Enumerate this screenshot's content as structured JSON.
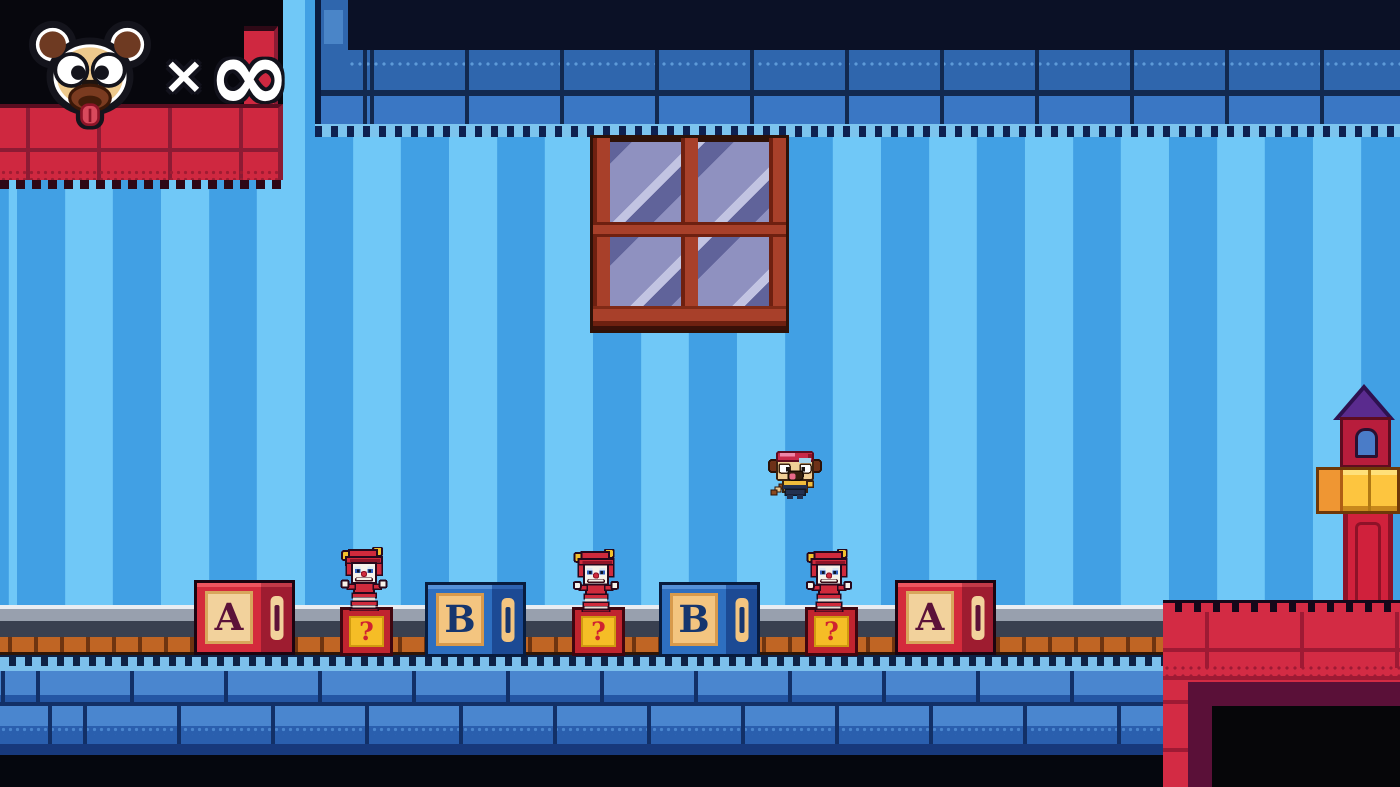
{
  "hud": {
    "icon": "pug-face",
    "multiplier_symbol": "×",
    "lives_count": "∞"
  },
  "level": {
    "blocks": [
      {
        "type": "letter-block",
        "letter": "A",
        "color": "red"
      },
      {
        "type": "question-block",
        "letter": "?",
        "color": "yellow"
      },
      {
        "type": "letter-block",
        "letter": "B",
        "color": "blue"
      },
      {
        "type": "question-block",
        "letter": "?",
        "color": "yellow"
      },
      {
        "type": "letter-block",
        "letter": "B",
        "color": "blue"
      },
      {
        "type": "question-block",
        "letter": "?",
        "color": "yellow"
      },
      {
        "type": "letter-block",
        "letter": "A",
        "color": "red"
      }
    ],
    "enemies": [
      {
        "type": "jack-in-the-box-clown"
      },
      {
        "type": "jack-in-the-box-clown"
      },
      {
        "type": "jack-in-the-box-clown"
      }
    ],
    "player": {
      "type": "pug-hero",
      "state": "jumping"
    },
    "scenery": [
      "window",
      "tower",
      "conveyor-rail",
      "brick-floor",
      "red-brick-archway"
    ]
  },
  "palette": {
    "stripe_light": "#70c8f7",
    "stripe_dark": "#41a0e4",
    "floor_brick": "#4a86cf",
    "red_brick": "#d32b44",
    "block_red": "#d42b3c",
    "block_blue": "#2e6fc0",
    "question_yellow": "#f5bd26",
    "rail_gray": "#98a0ae",
    "rail_orange": "#c06524",
    "window_frame": "#a8402a",
    "window_glass": "#8f91c0",
    "tower_roof_purple": "#5a2b8e",
    "tower_band_yellow": "#fdc53f",
    "hud_text": "#ffffff"
  }
}
